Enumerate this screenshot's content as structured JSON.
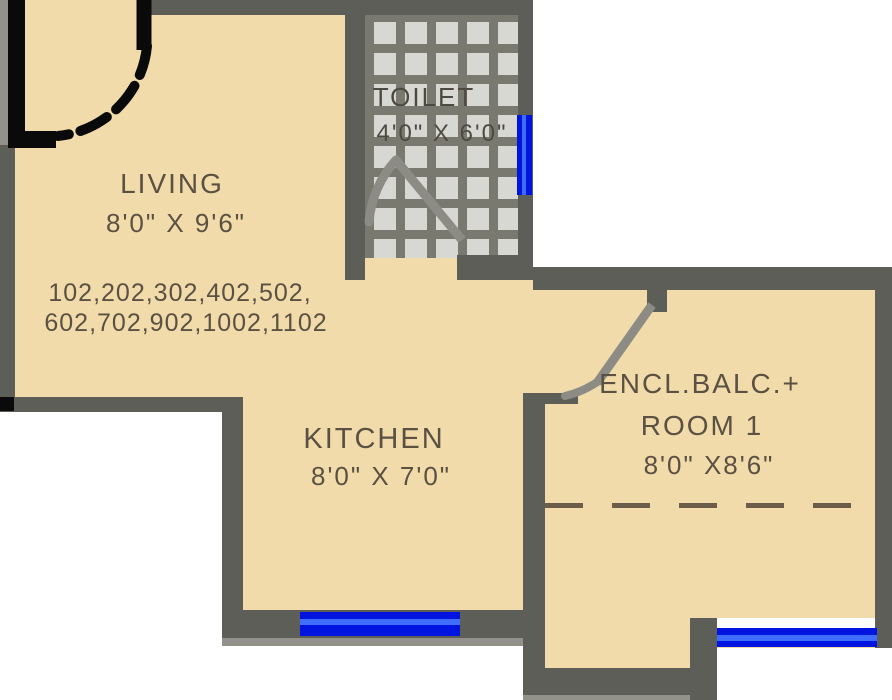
{
  "rooms": {
    "living": {
      "name": "LIVING",
      "dims": "8'0\" X 9'6\""
    },
    "toilet": {
      "name": "TOILET",
      "dims": "4'0\" X 6'0\""
    },
    "kitchen": {
      "name": "KITCHEN",
      "dims": "8'0\" X 7'0\""
    },
    "encl_balc": {
      "name_line1": "ENCL.BALC.+",
      "name_line2": "ROOM 1",
      "dims": "8'0\" X8'6\""
    }
  },
  "unit_numbers": {
    "line1": "102,202,302,402,502,",
    "line2": "602,702,902,1002,1102"
  },
  "colors": {
    "floor": "#f2dbaa",
    "wall": "#5e5e59",
    "window": "#0014e0",
    "tile": "#d8d8d3",
    "text": "#5a5143",
    "entrance_door": "#0a0a0a"
  }
}
